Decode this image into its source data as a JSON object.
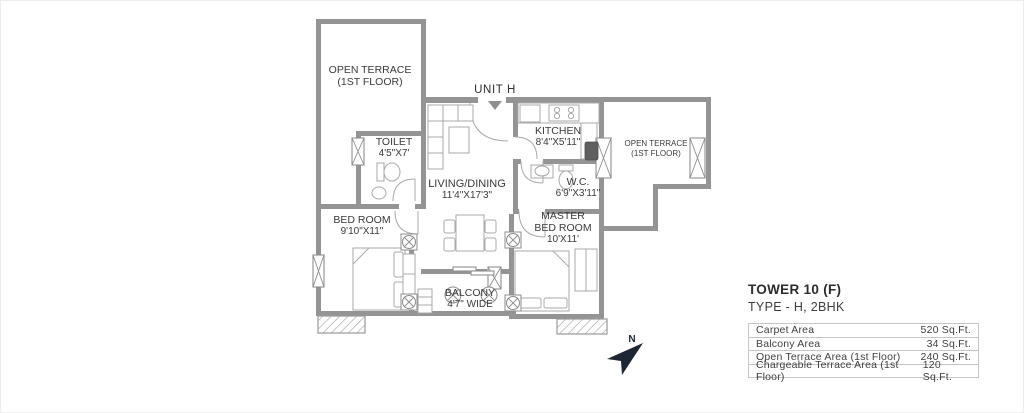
{
  "plan": {
    "unit": "UNIT H",
    "north": "N",
    "labels": {
      "terrace_left_1": "OPEN TERRACE",
      "terrace_left_2": "(1ST FLOOR)",
      "toilet_1": "TOILET",
      "toilet_2": "4'5\"X7'",
      "kitchen_1": "KITCHEN",
      "kitchen_2": "8'4\"X5'11\"",
      "terrace_right_1": "OPEN TERRACE",
      "terrace_right_2": "(1ST FLOOR)",
      "living_1": "LIVING/DINING",
      "living_2": "11'4\"X17'3\"",
      "wc_1": "W.C.",
      "wc_2": "6'9\"X3'11\"",
      "bedroom_1": "BED ROOM",
      "bedroom_2": "9'10\"X11\"",
      "master_1": "MASTER",
      "master_2": "BED ROOM",
      "master_3": "10'X11'",
      "balcony_1": "BALCONY",
      "balcony_2": "4'7\" WIDE"
    }
  },
  "info": {
    "title": "TOWER 10 (F)",
    "subtitle": "TYPE - H, 2BHK",
    "rows": [
      {
        "label": "Carpet Area",
        "value": "520 Sq.Ft."
      },
      {
        "label": "Balcony Area",
        "value": "34 Sq.Ft."
      },
      {
        "label": "Open Terrace Area (1st Floor)",
        "value": "240 Sq.Ft."
      },
      {
        "label": "Chargeable Terrace Area (1st Floor)",
        "value": "120 Sq.Ft."
      }
    ]
  },
  "colors": {
    "wall": "#949494",
    "furniture_line": "#a9a9a9",
    "plan_text": "#3a3a3a",
    "info_text": "#3f3f3f",
    "table_border": "#c6c6c6",
    "north_arrow": "#1d2733",
    "background": "#ffffff"
  }
}
